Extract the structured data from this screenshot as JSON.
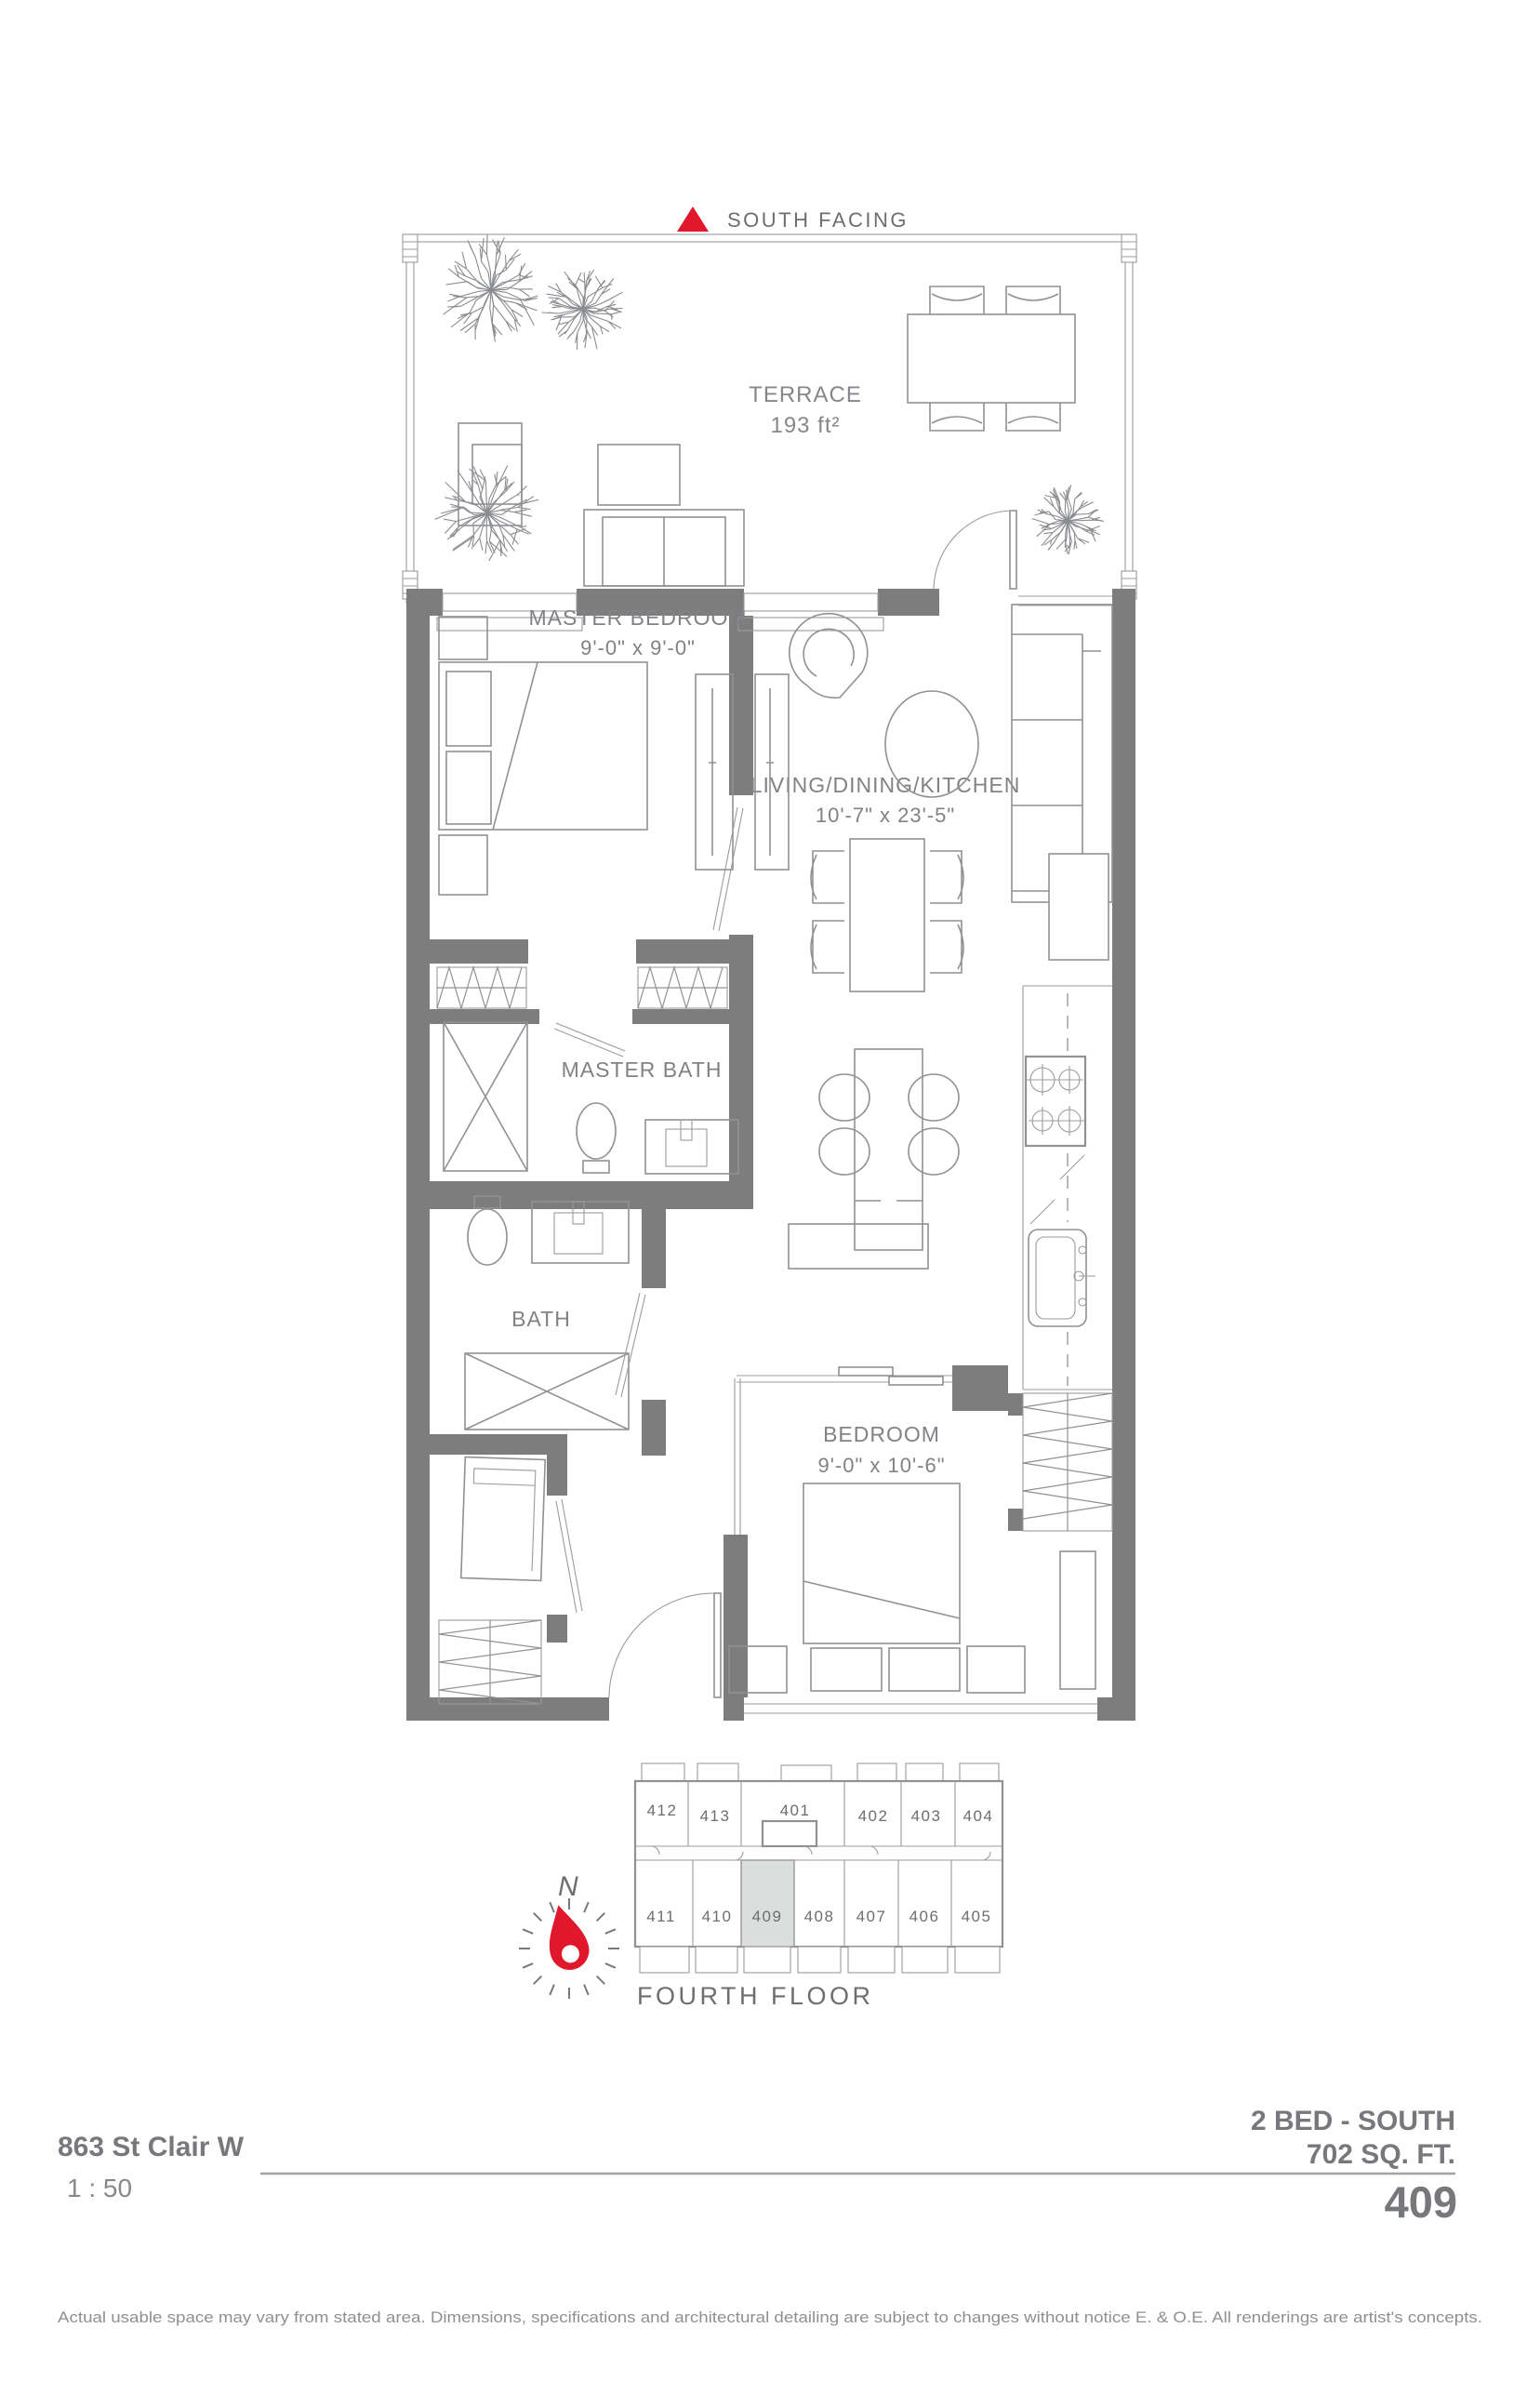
{
  "header": {
    "label": "SOUTH FACING"
  },
  "rooms": {
    "terrace": {
      "name": "TERRACE",
      "area": "193 ft²"
    },
    "master_bedroom": {
      "name": "MASTER BEDROOM",
      "dims": "9'-0\" x 9'-0\""
    },
    "living": {
      "name": "LIVING/DINING/KITCHEN",
      "dims": "10'-7\" x 23'-5\""
    },
    "master_bath": {
      "name": "MASTER BATH"
    },
    "bath": {
      "name": "BATH"
    },
    "bedroom": {
      "name": "BEDROOM",
      "dims": "9'-0\" x 10'-6\""
    }
  },
  "keyplan": {
    "floor_label": "FOURTH FLOOR",
    "north_label": "N",
    "highlighted_unit": "409",
    "top_units": [
      "412",
      "413",
      "401",
      "402",
      "403",
      "404"
    ],
    "bottom_units": [
      "411",
      "410",
      "409",
      "408",
      "407",
      "406",
      "405"
    ]
  },
  "footer": {
    "address": "863 St Clair W",
    "scale": "1 : 50",
    "unit_type": "2 BED - SOUTH",
    "area": "702 SQ. FT.",
    "unit_number": "409",
    "disclaimer": "Actual usable space may vary from stated area. Dimensions, specifications and architectural detailing are subject to changes without notice E. & O.E. All renderings are artist's concepts."
  },
  "colors": {
    "accent_red": "#e1182b",
    "wall_gray": "#7d7d7e",
    "line_gray": "#8f9194",
    "text_gray": "#808285",
    "highlight_gray": "#dcdddd"
  }
}
